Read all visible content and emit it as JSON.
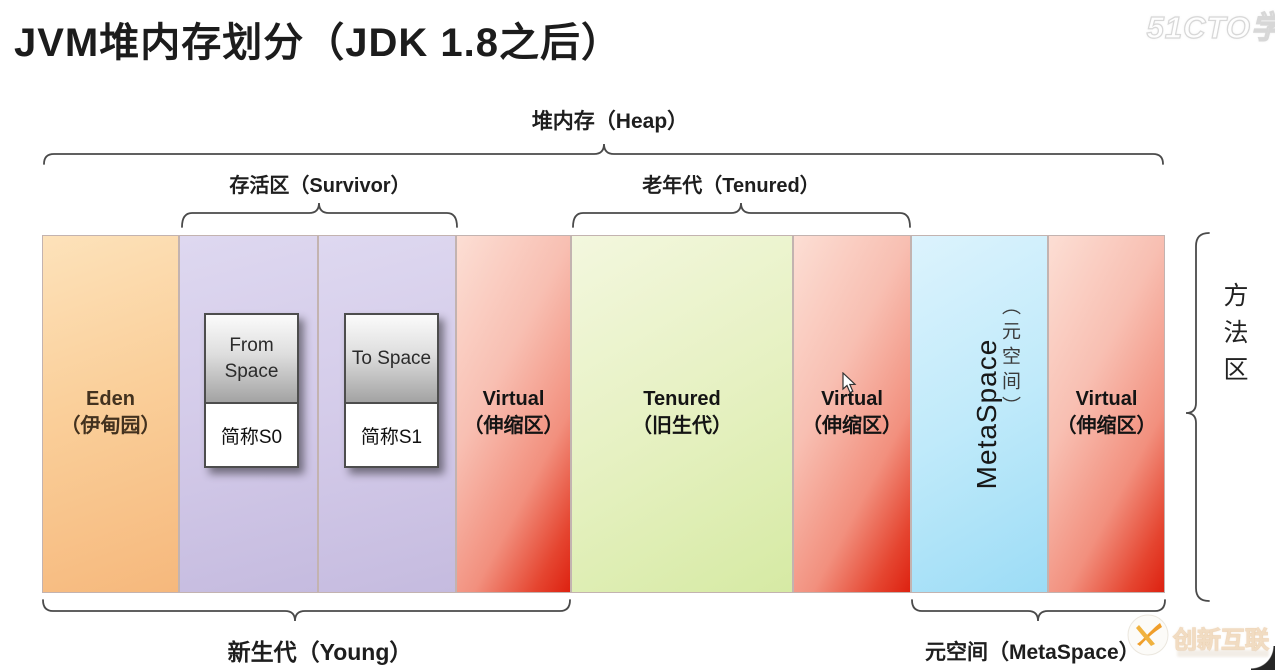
{
  "title": "JVM堆内存划分（JDK 1.8之后）",
  "braces": {
    "heap_label": "堆内存（Heap）",
    "survivor_label": "存活区（Survivor）",
    "tenured_label": "老年代（Tenured）",
    "young_label": "新生代（Young）",
    "metaspace_label": "元空间（MetaSpace）",
    "method_area_label": "方法区"
  },
  "blocks": {
    "eden": {
      "en": "Eden",
      "zh": "（伊甸园）"
    },
    "s0": {
      "space": "From Space",
      "alias": "简称S0"
    },
    "s1": {
      "space": "To Space",
      "alias": "简称S1"
    },
    "virtual_young": {
      "en": "Virtual",
      "zh": "（伸缩区）"
    },
    "tenured": {
      "en": "Tenured",
      "zh": "（旧生代）"
    },
    "virtual_tenured": {
      "en": "Virtual",
      "zh": "（伸缩区）"
    },
    "metaspace": {
      "en": "MetaSpace",
      "zh": "（元空间）"
    },
    "virtual_metaspace": {
      "en": "Virtual",
      "zh": "（伸缩区）"
    }
  },
  "watermarks": {
    "top_right": "51CTO学",
    "bottom_right": "创新互联"
  },
  "colors": {
    "eden_orange": "#f6b87c",
    "survivor_purple": "#c5bbdf",
    "virtual_red": "#dd2110",
    "tenured_green": "#d6eaa4",
    "metaspace_blue": "#9cdcf6",
    "space_box_gray": "#a3a3a3",
    "brace_stroke": "#4a4a4a",
    "brand_orange": "#f09e2a"
  }
}
